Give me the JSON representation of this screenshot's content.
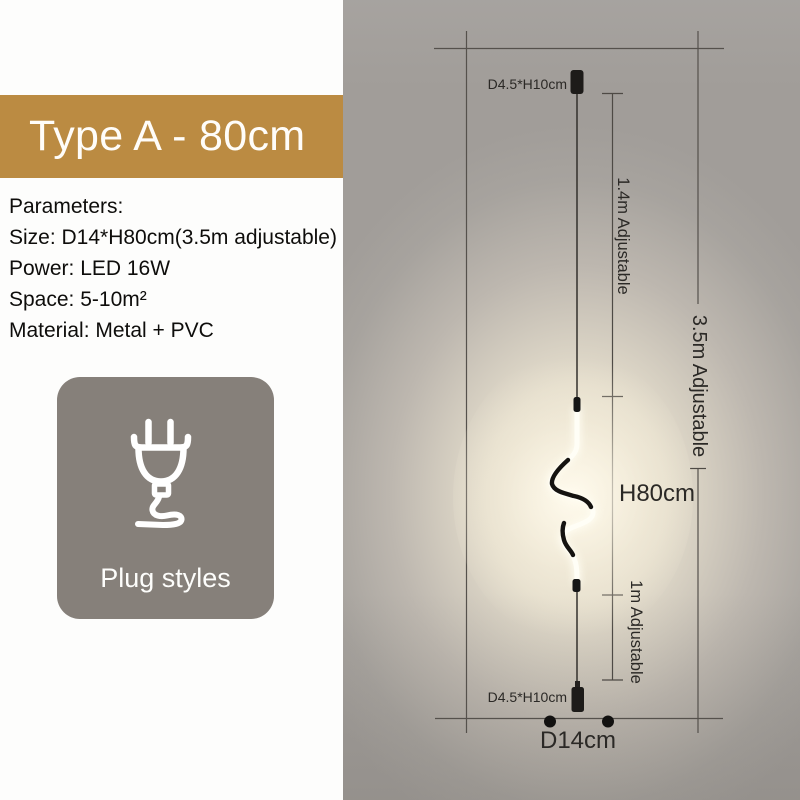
{
  "title_banner": {
    "label": "Type A - 80cm"
  },
  "parameters": {
    "heading": "Parameters:",
    "size": "Size: D14*H80cm(3.5m adjustable)",
    "power": "Power: LED 16W",
    "space": "Space: 5-10m²",
    "material": "Material: Metal + PVC"
  },
  "plug": {
    "label": "Plug styles"
  },
  "diagram": {
    "labels": {
      "top_mount": "D4.5*H10cm",
      "bottom_mount": "D4.5*H10cm",
      "upper_adjust": "1.4m Adjustable",
      "total_adjust": "3.5m Adjustable",
      "lamp_height": "H80cm",
      "lower_adjust": "1m Adjustable",
      "base_diameter": "D14cm"
    }
  },
  "colors": {
    "banner_gold": "#bb8b42",
    "plug_card_gray": "#86807a",
    "panel_gray": "#a5a19d",
    "glow_warm": "#f7f0e0",
    "fixture_black": "#1d1b19",
    "annotation_line": "#4e4a45",
    "text_dark": "#2b2926"
  }
}
